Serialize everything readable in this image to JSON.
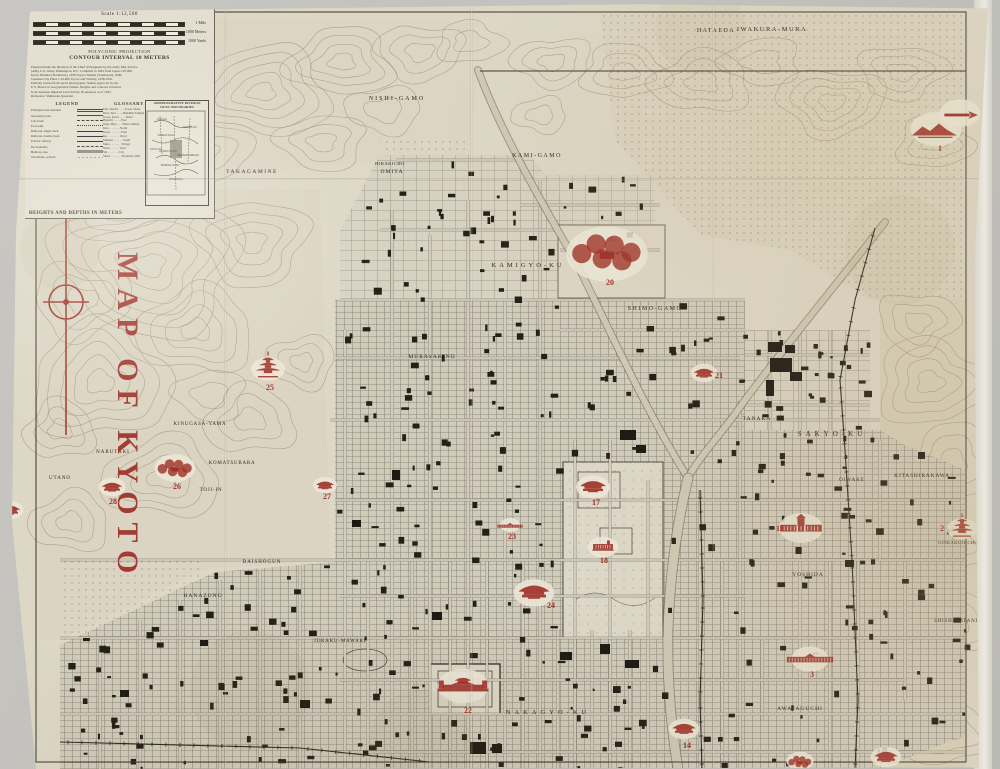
{
  "map_title": "MAP OF KYOTO",
  "colors": {
    "overprint_red": "#9e2f26",
    "paper": "#ddd7c6",
    "ink": "#2e2a20",
    "contour": "#a08f73"
  },
  "header": {
    "scale_label": "Scale 1:12,500",
    "scale_bars": [
      "1 Mile",
      "1000 Meters",
      "1000 Yards"
    ],
    "projection": "POLYCONIC PROJECTION",
    "contour_note": "CONTOUR INTERVAL 10 METERS",
    "credit_lines": [
      "Prepared under the direction of the Chief of Engineers by the Army Map Service",
      "(AM), U.S. Army, Washington, D.C. Compiled in 1945 from Japan 1:25,000,",
      "Kyoto Hokubu (Northwest), 1930; Kyoto Nambu (Southwest), 1930;",
      "Japanese City Plans 1:10,000, Kyoto and Vicinity, 1928-1935.",
      "Partially revised from aerial photography. Names approved by the",
      "U.S. Board on Geographical Names. Heights and contours in meters",
      "from Japanese Imperial Land Survey. Boundaries as of 1945.",
      "Reference: Shimazaki Quadrant."
    ],
    "legend_title": "LEGEND",
    "legend_items": [
      {
        "label": "Principal road, metaled",
        "style": "double"
      },
      {
        "label": "Secondary road",
        "style": "solid"
      },
      {
        "label": "Cart track",
        "style": "dashed"
      },
      {
        "label": "Foot path",
        "style": "dotted"
      },
      {
        "label": "Railroad, single track",
        "style": "rail"
      },
      {
        "label": "Railroad, double track",
        "style": "rail"
      },
      {
        "label": "Electric railway",
        "style": "rail"
      },
      {
        "label": "Ku boundary",
        "style": "dashed"
      },
      {
        "label": "Built-up area",
        "style": "block"
      },
      {
        "label": "Woodland, orchard",
        "style": "dots"
      }
    ],
    "glossary_title": "GLOSSARY",
    "glossary_entries": [
      "Cho, Machi . . . . Town, Street",
      "Dera, Tera . . . . Buddhist Temple",
      "Gawa, Kawa . . . . River",
      "Higashi . . . . . East",
      "Jinja, Miya . . . Shinto Shrine",
      "Kita . . . . . . . North",
      "Koen . . . . . . . Park",
      "Ku . . . . . . . . Ward",
      "Minami . . . . . . South",
      "Mura . . . . . . . Village",
      "Nishi . . . . . . West",
      "Shi . . . . . . . City",
      "Yama . . . . . . . Mountain, Hill"
    ],
    "inset_title_1": "ADMINISTRATIVE DIVISION",
    "inset_title_2": "OF KU BOUNDARIES",
    "inset_wards": [
      "KITA-KU",
      "SAKYO-KU",
      "KAMIGYO-KU",
      "UKYO-KU",
      "NAKAGYO-KU",
      "HIGASHIYAMA-KU",
      "SHIMOGYO-KU",
      "MINAMI-KU"
    ],
    "heights_note": "HEIGHTS AND DEPTHS IN METERS"
  },
  "map": {
    "landmarks": [
      {
        "num": "1",
        "type": "mountain",
        "x": 936,
        "y": 131,
        "s": 15,
        "nx": 940,
        "ny": 151
      },
      {
        "num": "",
        "type": "arrow",
        "x": 960,
        "y": 115,
        "s": 12,
        "nx": 0,
        "ny": 0
      },
      {
        "num": "2",
        "type": "pagoda",
        "x": 962,
        "y": 531,
        "s": 9,
        "nx": 942,
        "ny": 531
      },
      {
        "num": "3",
        "type": "longbuilding",
        "x": 810,
        "y": 661,
        "s": 11,
        "nx": 812,
        "ny": 677
      },
      {
        "num": "14",
        "type": "temple",
        "x": 684,
        "y": 731,
        "s": 9,
        "nx": 687,
        "ny": 748
      },
      {
        "num": "17",
        "type": "temple",
        "x": 593,
        "y": 489,
        "s": 10,
        "nx": 596,
        "ny": 505
      },
      {
        "num": "18",
        "type": "building",
        "x": 603,
        "y": 549,
        "s": 9,
        "nx": 604,
        "ny": 563
      },
      {
        "num": "19",
        "type": "bigbuilding",
        "x": 801,
        "y": 530,
        "s": 13,
        "nx": 780,
        "ny": 531
      },
      {
        "num": "20",
        "type": "garden",
        "x": 607,
        "y": 256,
        "s": 24,
        "nx": 610,
        "ny": 285
      },
      {
        "num": "21",
        "type": "temple",
        "x": 704,
        "y": 375,
        "s": 8,
        "nx": 719,
        "ny": 378
      },
      {
        "num": "22",
        "type": "castle",
        "x": 463,
        "y": 688,
        "s": 15,
        "nx": 468,
        "ny": 713
      },
      {
        "num": "23",
        "type": "longbuilding",
        "x": 510,
        "y": 527,
        "s": 6,
        "nx": 512,
        "ny": 539
      },
      {
        "num": "24",
        "type": "temple",
        "x": 534,
        "y": 595,
        "s": 12,
        "nx": 551,
        "ny": 608
      },
      {
        "num": "25",
        "type": "pagoda",
        "x": 268,
        "y": 371,
        "s": 10,
        "nx": 270,
        "ny": 390
      },
      {
        "num": "26",
        "type": "garden",
        "x": 175,
        "y": 470,
        "s": 12,
        "nx": 177,
        "ny": 489
      },
      {
        "num": "27",
        "type": "temple",
        "x": 325,
        "y": 487,
        "s": 7,
        "nx": 327,
        "ny": 499
      },
      {
        "num": "28",
        "type": "temple",
        "x": 112,
        "y": 489,
        "s": 8,
        "nx": 113,
        "ny": 504
      },
      {
        "num": "",
        "type": "temple",
        "x": 10,
        "y": 512,
        "s": 8,
        "nx": 0,
        "ny": 0
      },
      {
        "num": "",
        "type": "temple",
        "x": 886,
        "y": 759,
        "s": 9,
        "nx": 0,
        "ny": 0
      },
      {
        "num": "",
        "type": "garden",
        "x": 800,
        "y": 763,
        "s": 8,
        "nx": 0,
        "ny": 0
      }
    ],
    "labels": [
      {
        "t": "HATAEDA",
        "x": 716,
        "y": 32,
        "s": 6,
        "sp": 1.5
      },
      {
        "t": "IWAKURA-MURA",
        "x": 772,
        "y": 31,
        "s": 6.5,
        "sp": 1.5
      },
      {
        "t": "NISHI-GAMO",
        "x": 397,
        "y": 100,
        "s": 6,
        "sp": 2
      },
      {
        "t": "KAMI-GAMO",
        "x": 537,
        "y": 157,
        "s": 6,
        "sp": 1.5
      },
      {
        "t": "TAKAGAMINE",
        "x": 252,
        "y": 173,
        "s": 5.5,
        "sp": 1.5
      },
      {
        "t": "HIRAKICHO",
        "x": 390,
        "y": 165,
        "s": 4.5,
        "sp": 0.5
      },
      {
        "t": "OMIYA",
        "x": 392,
        "y": 173,
        "s": 5.5,
        "sp": 1
      },
      {
        "t": "MURASAKINO",
        "x": 432,
        "y": 358,
        "s": 5.5,
        "sp": 1
      },
      {
        "t": "KAMIGYO-KU",
        "x": 528,
        "y": 267,
        "s": 6.5,
        "sp": 3
      },
      {
        "t": "SHIMO-GAMO",
        "x": 655,
        "y": 310,
        "s": 6,
        "sp": 1.5
      },
      {
        "t": "TANAKA",
        "x": 757,
        "y": 420,
        "s": 5.5,
        "sp": 1
      },
      {
        "t": "SAKYO-KU",
        "x": 832,
        "y": 436,
        "s": 7,
        "sp": 4
      },
      {
        "t": "KITASHIRAKAWA",
        "x": 922,
        "y": 477,
        "s": 5.5,
        "sp": 0.8
      },
      {
        "t": "OIWAKE",
        "x": 852,
        "y": 481,
        "s": 5,
        "sp": 1
      },
      {
        "t": "YOSHIDA",
        "x": 808,
        "y": 576,
        "s": 5.5,
        "sp": 1
      },
      {
        "t": "GINKAKUJI-CHO",
        "x": 958,
        "y": 544,
        "s": 4.5,
        "sp": 0.4
      },
      {
        "t": "SHISHIGATANI",
        "x": 956,
        "y": 622,
        "s": 5,
        "sp": 0.8
      },
      {
        "t": "AWATAGUCHI",
        "x": 800,
        "y": 710,
        "s": 5.5,
        "sp": 1
      },
      {
        "t": "NAKAGYO-KU",
        "x": 548,
        "y": 714,
        "s": 6.5,
        "sp": 4
      },
      {
        "t": "KINUGASA-YAMA",
        "x": 200,
        "y": 425,
        "s": 5,
        "sp": 0.8
      },
      {
        "t": "KOMATSUBARA",
        "x": 232,
        "y": 464,
        "s": 5,
        "sp": 0.8
      },
      {
        "t": "TOJI-IN",
        "x": 211,
        "y": 491,
        "s": 5,
        "sp": 0.8
      },
      {
        "t": "UTANO",
        "x": 60,
        "y": 479,
        "s": 5,
        "sp": 1
      },
      {
        "t": "NARUTAKI",
        "x": 113,
        "y": 453,
        "s": 5,
        "sp": 1
      },
      {
        "t": "HANAZONO",
        "x": 203,
        "y": 597,
        "s": 5.5,
        "sp": 1
      },
      {
        "t": "DAISHOGUN",
        "x": 262,
        "y": 563,
        "s": 5,
        "sp": 1
      },
      {
        "t": "JURAKU-MAWARI",
        "x": 340,
        "y": 642,
        "s": 5,
        "sp": 0.8
      }
    ]
  }
}
